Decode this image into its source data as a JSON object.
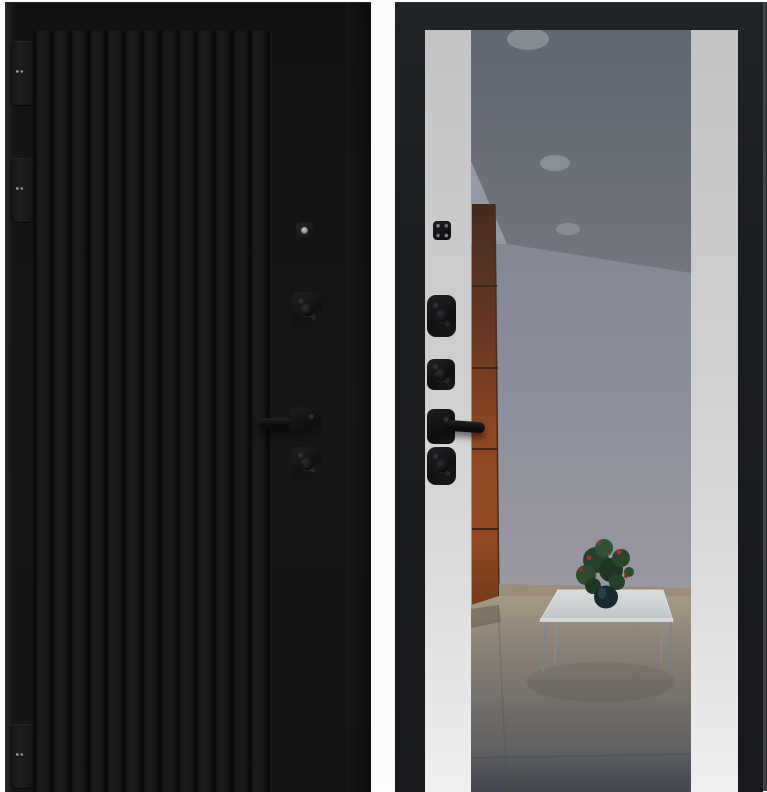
{
  "scene": {
    "type": "product-photo",
    "subject": "metal entrance door shown from both sides",
    "text_content": "none (image contains no visible text)",
    "left_panel": {
      "side": "exterior",
      "finish": "matte black with vertical slat milling on left two-thirds",
      "hardware": [
        "three edge hinges",
        "peephole-cylinder",
        "upper keyhole escutcheon",
        "lever handle pointing left",
        "lower keyhole escutcheon"
      ]
    },
    "right_panel": {
      "side": "interior",
      "finish": "black frame, light grey side panels, full-height central mirror",
      "hardware": [
        "thumb-turn square",
        "upper escutcheon",
        "middle escutcheon",
        "lever handle pointing right",
        "lower escutcheon"
      ],
      "mirror_reflection": [
        "grey ceiling with three recessed round downlights",
        "white hallway wall",
        "orange-brown tall cabinet with horizontal seams",
        "beige tiled floor turning grey toward viewer",
        "glass coffee table on thin metal legs",
        "green potted plant with red blooms in dark round vase"
      ]
    }
  },
  "palette": {
    "bg_white": "#ffffff",
    "gap_white": "#fcfcfc",
    "door_black": "#141416",
    "groove": "#0a0a0b",
    "frame_black": "#1b1e21",
    "panel_light": "#c9cacb",
    "panel_bottom": "#efefef",
    "hardware_black": "#131315",
    "ceiling_grey": "#5d636c",
    "downlight_grey": "#878d94",
    "wall_grey": "#8f939e",
    "wall_light": "#9aa0a8",
    "cabinet_orange": "#94451d",
    "cabinet_dark": "#3f2315",
    "floor_beige": "#b0a28c",
    "floor_grey": "#6d7076",
    "table_glass": "#e0e5e5",
    "plant_green": "#243f26",
    "plant_red": "#993128",
    "vase_teal": "#16272a",
    "edge_shadow": "#3f4246"
  }
}
